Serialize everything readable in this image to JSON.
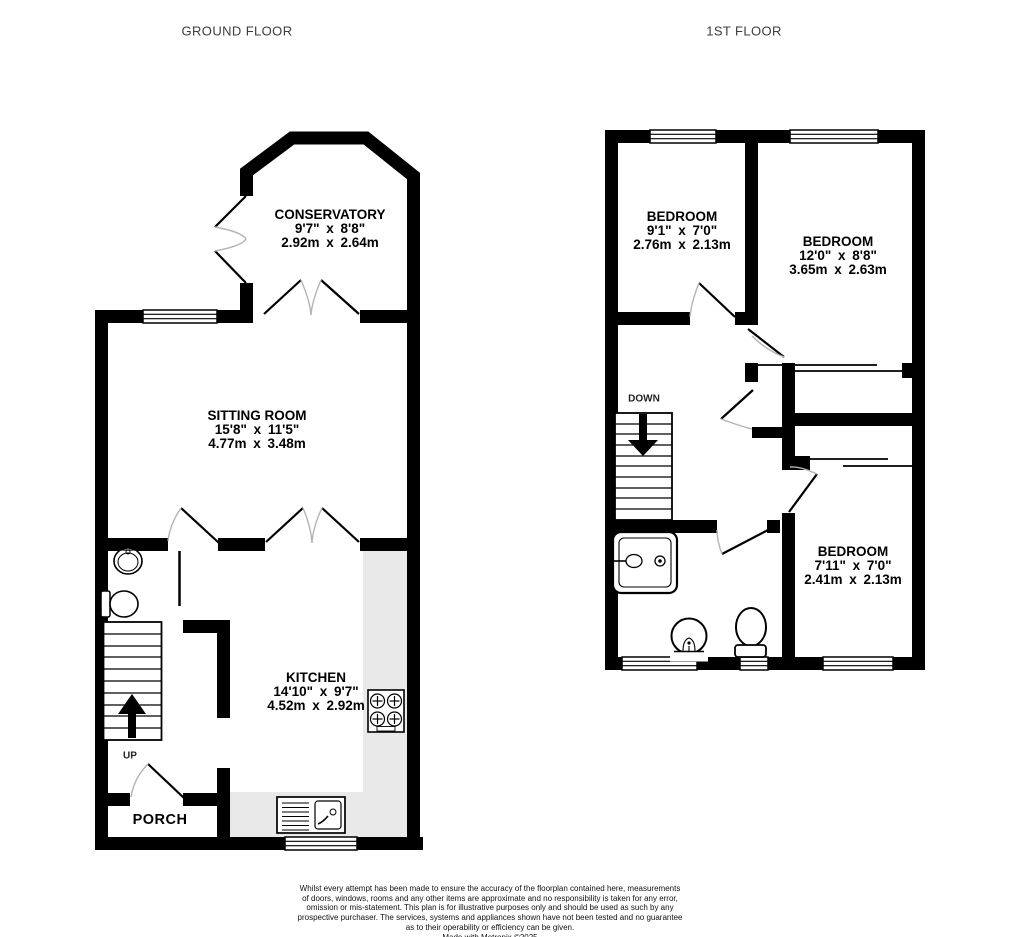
{
  "colors": {
    "wall": "#000000",
    "counter": "#e9e9e9",
    "door_arc": "#b3b3b3"
  },
  "ground_floor": {
    "title": "GROUND FLOOR",
    "stairs_label": "UP",
    "rooms": {
      "conservatory": {
        "name": "CONSERVATORY",
        "imperial": "9'7\" x 8'8\"",
        "metric": "2.92m x 2.64m"
      },
      "sitting_room": {
        "name": "SITTING ROOM",
        "imperial": "15'8\" x 11'5\"",
        "metric": "4.77m x 3.48m"
      },
      "kitchen": {
        "name": "KITCHEN",
        "imperial": "14'10\" x 9'7\"",
        "metric": "4.52m x 2.92m"
      },
      "porch": {
        "name": "PORCH"
      }
    }
  },
  "first_floor": {
    "title": "1ST FLOOR",
    "stairs_label": "DOWN",
    "rooms": {
      "bedroom_1": {
        "name": "BEDROOM",
        "imperial": "9'1\" x 7'0\"",
        "metric": "2.76m x 2.13m"
      },
      "bedroom_2": {
        "name": "BEDROOM",
        "imperial": "12'0\" x 8'8\"",
        "metric": "3.65m x 2.63m"
      },
      "bedroom_3": {
        "name": "BEDROOM",
        "imperial": "7'11\" x 7'0\"",
        "metric": "2.41m x 2.13m"
      }
    }
  },
  "footer": {
    "disclaimer_lines": [
      "Whilst every attempt has been made to ensure the accuracy of the floorplan contained here, measurements",
      "of doors, windows, rooms and any other items are approximate and no responsibility is taken for any error,",
      "omission or mis-statement. This plan is for illustrative purposes only and should be used as such by any",
      "prospective purchaser. The services, systems and appliances shown have not been tested and no guarantee",
      "as to their operability or efficiency can be given.",
      "Made with Metropix ©2025"
    ]
  },
  "icons": {
    "hob": "hob-icon",
    "kitchen_sink": "kitchen-sink-icon",
    "wc_basin": "basin-icon",
    "wc_toilet": "toilet-icon",
    "shower": "shower-icon",
    "pedestal_basin": "pedestal-basin-icon",
    "bathroom_toilet": "toilet-icon",
    "up_arrow": "up-arrow-icon",
    "down_arrow": "down-arrow-icon"
  }
}
